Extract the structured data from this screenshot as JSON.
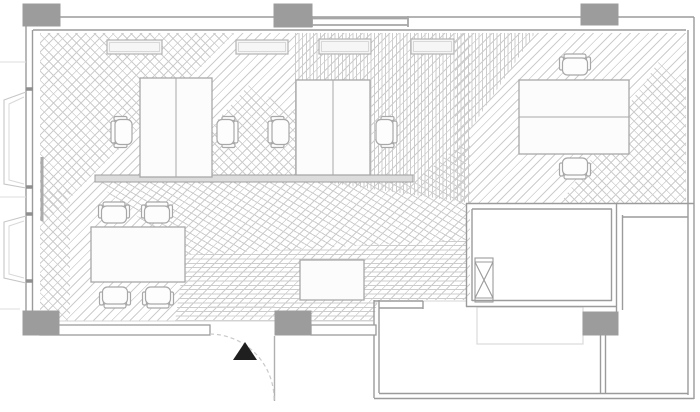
{
  "meta": {
    "title": "Office floor plan",
    "canvas_width": 700,
    "canvas_height": 412
  },
  "palette": {
    "background": "#ffffff",
    "hatch_line": "#cdcdcd",
    "floor_edge": "#d6d6d6",
    "wall": "#9b9b9b",
    "column_fill": "#9c9c9c",
    "furniture_stroke": "#a8a8a8",
    "furniture_fill": "#fcfcfc",
    "radiator_stroke": "#b3b3b3",
    "radiator_fill": "#f6f6f6",
    "radiator_inner": "#d8d8d8",
    "shelf_fill": "#dcdcdc",
    "shelf_stroke": "#9f9f9f",
    "stair_flight_stroke": "#dadada",
    "door_leaf": "#b0b0b0",
    "door_arc": "#c9c9c9",
    "casement_stroke": "#c6c6c6",
    "casement_inner": "#d8d8d8",
    "sill_tick": "#8f8f8f",
    "window_band": "#a6a6a6",
    "exterior_line": "#dedede",
    "pier": "#ababab",
    "marker_fill": "#1f1f1f"
  },
  "floor_zones": [
    {
      "name": "parquet-diagonal-left-main",
      "x": 40,
      "y": 33,
      "w": 430,
      "h": 288,
      "angle": 135,
      "period": 6.5,
      "clip": "polygon(0px 0px, 430px 0px, 430px 267px, 338px 267px, 333px 288px, 0px 288px)"
    },
    {
      "name": "parquet-corner-top-left",
      "x": 40,
      "y": 33,
      "w": 195,
      "h": 195,
      "angle": 45,
      "period": 6.5,
      "clip": "polygon(0px 0px, 195px 0px, 0px 195px)"
    },
    {
      "name": "parquet-left-band",
      "x": 40,
      "y": 190,
      "w": 30,
      "h": 131,
      "angle": 45,
      "period": 6.5,
      "clip": null
    },
    {
      "name": "parquet-between-desks",
      "x": 193,
      "y": 85,
      "w": 102,
      "h": 93,
      "angle": 45,
      "period": 6.5,
      "clip": "polygon(56px 0px, 102px 28px, 102px 93px, 0px 93px, 20px 40px)"
    },
    {
      "name": "parquet-top-right",
      "x": 455,
      "y": 33,
      "w": 231,
      "h": 171,
      "angle": 135,
      "period": 6.5,
      "clip": null
    },
    {
      "name": "parquet-vertical-middle",
      "x": 295,
      "y": 33,
      "w": 240,
      "h": 170,
      "angle": 90,
      "period": 3.6,
      "clip": "polygon(0px 0px, 240px 0px, 175px 97px, 175px 170px, 0px 145px)"
    },
    {
      "name": "parquet-corner-right",
      "x": 560,
      "y": 60,
      "w": 126,
      "h": 144,
      "angle": 45,
      "period": 6.5,
      "clip": "polygon(100px 0px, 126px 20px, 126px 144px, 0px 144px)"
    },
    {
      "name": "parquet-sweep-band",
      "x": 95,
      "y": 140,
      "w": 371,
      "h": 115,
      "angle": 30,
      "period": 6,
      "clip": "polygon(0px 42px, 318px 42px, 371px 0px, 371px 100px, 90px 115px)"
    },
    {
      "name": "parquet-horizontal-bottom",
      "x": 175,
      "y": 240,
      "w": 291,
      "h": 81,
      "angle": 0,
      "period": 4.4,
      "clip": "polygon(10px 15px, 291px 0px, 291px 60px, 203px 60px, 198px 81px, 0px 81px)"
    }
  ],
  "columns": [
    [
      23,
      4,
      37,
      22
    ],
    [
      274,
      4,
      38,
      23
    ],
    [
      581,
      4,
      37,
      21
    ],
    [
      23,
      311,
      36,
      24
    ],
    [
      275,
      311,
      36,
      24
    ],
    [
      583,
      312,
      35,
      23
    ]
  ],
  "walls": {
    "lines": [
      [
        26,
        17,
        694,
        17
      ],
      [
        33,
        30,
        686,
        30
      ],
      [
        26,
        17,
        26,
        335
      ],
      [
        32.5,
        30,
        32.5,
        325
      ],
      [
        694,
        17,
        694,
        399
      ],
      [
        688,
        30,
        688,
        395
      ],
      [
        374,
        300,
        374,
        398
      ],
      [
        379,
        300,
        379,
        393
      ],
      [
        374,
        398.5,
        694,
        398.5
      ],
      [
        379,
        393.5,
        688,
        393.5
      ],
      [
        374,
        301,
        423,
        301
      ],
      [
        423,
        301,
        423,
        309
      ],
      [
        379,
        308,
        423,
        308
      ],
      [
        466,
        203.5,
        694,
        203.5
      ],
      [
        466.5,
        203,
        466.5,
        307
      ],
      [
        472,
        209,
        472,
        301
      ],
      [
        472,
        209,
        612,
        209
      ],
      [
        466,
        306.5,
        617,
        306.5
      ],
      [
        472,
        300.5,
        612,
        300.5
      ],
      [
        616.5,
        203,
        616.5,
        312
      ],
      [
        611.5,
        209,
        611.5,
        301
      ],
      [
        622.5,
        215,
        622.5,
        310
      ],
      [
        623,
        217,
        688,
        217
      ],
      [
        600.5,
        335,
        600.5,
        394
      ],
      [
        605.5,
        335,
        605.5,
        394
      ]
    ],
    "wall_rects": [
      [
        40,
        325,
        170,
        10
      ],
      [
        311,
        325,
        65,
        10
      ]
    ],
    "light_lines": [
      [
        423,
        301,
        467,
        301
      ],
      [
        40,
        321,
        373,
        321
      ],
      [
        210,
        307,
        275,
        307
      ],
      [
        210,
        316,
        275,
        316
      ]
    ]
  },
  "windows": {
    "top_band_lines": [
      [
        312,
        18.5,
        408,
        18.5
      ],
      [
        312,
        25,
        408,
        25
      ]
    ],
    "top_band_caps": [
      [
        312,
        16,
        312,
        27
      ],
      [
        408,
        16,
        408,
        27
      ]
    ],
    "left_casements": [
      {
        "outer": "M26,92 L4,100 L4,184 L26,188",
        "inner": "M24,97 L9,104 L9,180 L24,184"
      },
      {
        "outer": "M26,216 L4,222 L4,278 L26,283",
        "inner": "M24,221 L9,226 L9,274 L24,278"
      }
    ],
    "sill_ticks": [
      [
        26,
        89,
        33,
        89
      ],
      [
        26,
        187,
        33,
        187
      ],
      [
        26,
        214,
        33,
        214
      ],
      [
        26,
        281,
        33,
        281
      ]
    ],
    "exterior_lines": [
      [
        0,
        62,
        26,
        62
      ],
      [
        0,
        197,
        26,
        197
      ],
      [
        0,
        309,
        20,
        309
      ]
    ],
    "pier": [
      42,
      157,
      42,
      221
    ]
  },
  "furniture": {
    "desks": [
      {
        "name": "desk-pair-left",
        "x": 140,
        "y": 78,
        "w": 72,
        "h": 99,
        "divider": "v"
      },
      {
        "name": "desk-pair-middle",
        "x": 296,
        "y": 80,
        "w": 74,
        "h": 95,
        "divider": "v"
      },
      {
        "name": "desk-pair-right",
        "x": 519,
        "y": 80,
        "w": 110,
        "h": 74,
        "divider": "h"
      }
    ],
    "tables": [
      {
        "name": "meeting-table",
        "x": 91,
        "y": 227,
        "w": 94,
        "h": 55
      },
      {
        "name": "sideboard",
        "x": 300,
        "y": 260,
        "w": 64,
        "h": 40
      }
    ],
    "shelf": {
      "name": "low-shelf",
      "x": 95,
      "y": 175,
      "w": 318,
      "h": 7
    },
    "radiators": [
      [
        107,
        40,
        55,
        14
      ],
      [
        236,
        40,
        52,
        14
      ],
      [
        319,
        39,
        52,
        15
      ],
      [
        411,
        39,
        43,
        15
      ]
    ],
    "chair_shape": {
      "back": [
        -13,
        -11,
        4.5,
        22
      ],
      "seat": [
        -9,
        -12.5,
        17,
        25
      ],
      "arms": [
        [
          -10,
          -15.5,
          13,
          4
        ],
        [
          -10,
          11.5,
          13,
          4
        ]
      ]
    },
    "chairs": [
      [
        124,
        132,
        0
      ],
      [
        225,
        132,
        180
      ],
      [
        281,
        132,
        0
      ],
      [
        384,
        132,
        180
      ],
      [
        575,
        67,
        90
      ],
      [
        575,
        166,
        270
      ],
      [
        114,
        215,
        90
      ],
      [
        157,
        215,
        90
      ],
      [
        115,
        295,
        270
      ],
      [
        158,
        295,
        270
      ]
    ]
  },
  "stair_core": {
    "shaft": {
      "x": 475,
      "y": 258,
      "w": 18,
      "h": 44
    },
    "shaft_lines": [
      [
        475,
        262,
        493,
        262
      ],
      [
        475,
        298,
        493,
        298
      ],
      [
        475,
        262,
        493,
        298
      ],
      [
        493,
        262,
        475,
        298
      ]
    ],
    "flight": {
      "x": 477,
      "y": 307,
      "w": 106,
      "h": 37
    }
  },
  "door": {
    "leaf": [
      274.5,
      336,
      274.5,
      401
    ],
    "arc_path": "M 210 334 A 65 65 0 0 1 274 401"
  },
  "entrance_marker": {
    "points": "245,342 233,360 257,360"
  }
}
